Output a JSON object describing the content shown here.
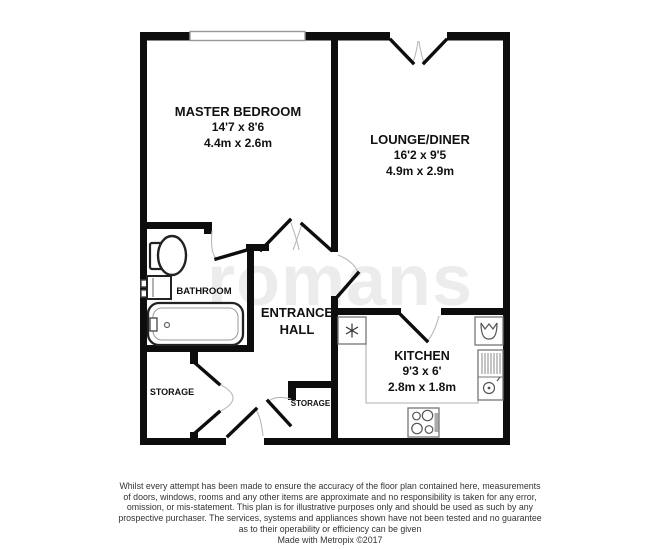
{
  "floorplan": {
    "watermark": "romans",
    "rooms": {
      "master_bedroom": {
        "name": "MASTER BEDROOM",
        "imperial": "14'7 x 8'6",
        "metric": "4.4m x 2.6m"
      },
      "lounge_diner": {
        "name": "LOUNGE/DINER",
        "imperial": "16'2 x 9'5",
        "metric": "4.9m x 2.9m"
      },
      "kitchen": {
        "name": "KITCHEN",
        "imperial": "9'3 x 6'",
        "metric": "2.8m x 1.8m"
      },
      "bathroom": {
        "name": "BATHROOM"
      },
      "entrance_hall": {
        "name": "ENTRANCE HALL"
      },
      "storage_left": {
        "name": "STORAGE"
      },
      "storage_right": {
        "name": "STORAGE"
      }
    },
    "colors": {
      "wall": "#0d0d0d",
      "window_border": "#9a9a9a",
      "door_arc": "#b8b8b8",
      "fixture_outline": "#444444",
      "counter_line": "#b0b0b0",
      "label_text": "#111111"
    }
  },
  "footer": {
    "lines": [
      "Whilst every attempt has been made to ensure the accuracy of the floor plan contained here, measurements",
      "of doors, windows, rooms and any other items are approximate and no responsibility is taken for any error,",
      "omission, or mis-statement. This plan is for illustrative purposes only and should be used as such by any",
      "prospective purchaser. The services, systems and appliances shown have not been tested and no guarantee",
      "as to their operability or efficiency can be given",
      "Made with Metropix ©2017"
    ]
  }
}
